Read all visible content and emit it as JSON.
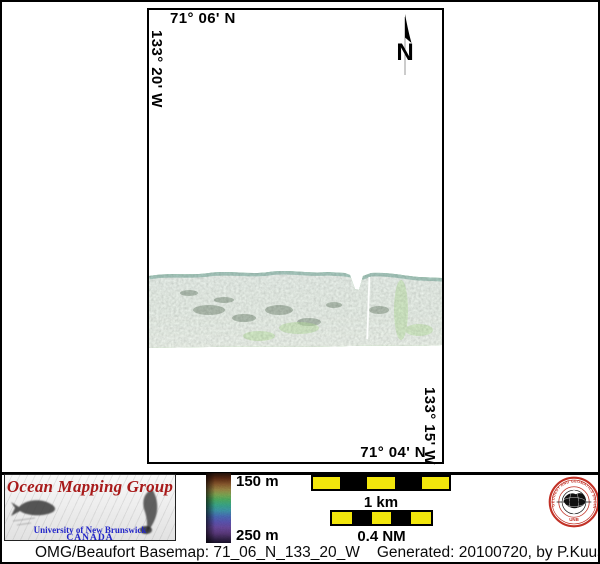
{
  "map": {
    "top_coordinate": "71° 06' N",
    "left_coordinate": "133° 20' W",
    "right_coordinate": "133° 15' W",
    "bottom_coordinate": "71° 04' N",
    "north_label": "N"
  },
  "legend": {
    "depth_top": "150 m",
    "depth_bottom": "250 m"
  },
  "scalebars": {
    "km_label": "1 km",
    "nm_label": "0.4 NM"
  },
  "logo": {
    "title": "Ocean Mapping Group",
    "institution": "University of New Brunswick",
    "country": "CANADA"
  },
  "seal": {
    "ring_text": "GEODESY AND GEOMATICS ENGINEERING",
    "acronym": "UNB"
  },
  "caption": {
    "basemap": "OMG/Beaufort Basemap: 71_06_N_133_20_W",
    "generated": "Generated: 20100720, by P.Kuus"
  },
  "colors": {
    "scalebar_yellow": "#f2e60c",
    "logo_red": "#a81a1a",
    "logo_blue": "#2326c8",
    "seal_red": "#c23126",
    "swath_green": "#5aa75a",
    "depth_colormap_top_to_bottom": [
      "#221008",
      "#5c2a12",
      "#8a5a2e",
      "#9c8a46",
      "#7fa853",
      "#4fae62",
      "#3aa88b",
      "#3f96ac",
      "#4a6cb8",
      "#5b54b2",
      "#6a4a9e",
      "#5c3a7e",
      "#3a2752",
      "#18102a"
    ]
  }
}
